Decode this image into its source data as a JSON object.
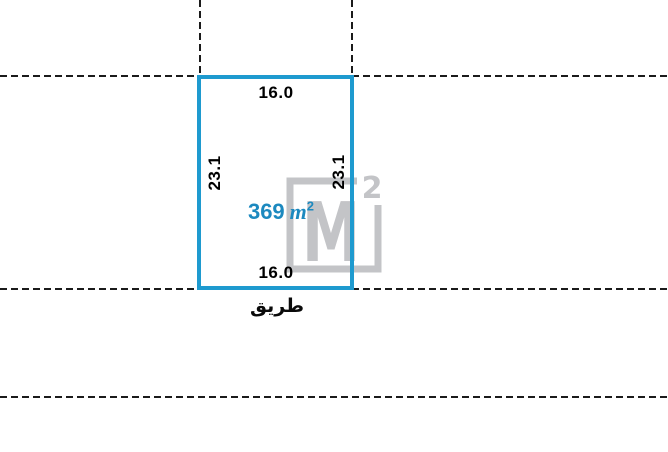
{
  "diagram": {
    "plot": {
      "top_width": "16.0",
      "bottom_width": "16.0",
      "left_depth": "23.1",
      "right_depth": "23.1",
      "area_value": "369",
      "area_unit": "m",
      "area_exponent": "2",
      "road_label": "طريق"
    },
    "watermark": {
      "letter": "M",
      "exponent": "2"
    },
    "colors": {
      "plot_border": "#1E9ACF",
      "area_text": "#1C89BF",
      "watermark_gray": "#C3C4C7",
      "boundary_dash": "#1B1B1B",
      "background": "#FFFFFF"
    }
  }
}
